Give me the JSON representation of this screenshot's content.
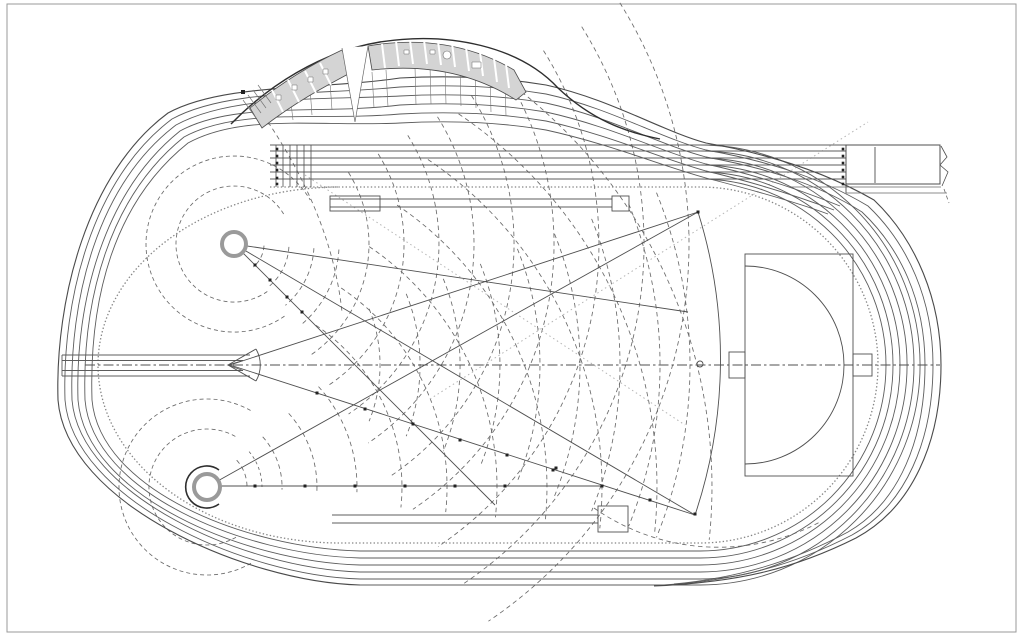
{
  "meta": {
    "description": "Architectural site plan drawing of an athletics stadium: six-lane 400m running track with sprint straight extension, curved grandstand building with changing rooms along the north curve, javelin runway and landing sector, two throwing circles with caged hammer/discus sectors, dashed distance arcs, long jump runways and a D-shaped event area inside the eastern curve"
  },
  "canvas": {
    "width": 1024,
    "height": 639,
    "background": "#ffffff"
  },
  "palette": {
    "line": "#4f4f4f",
    "track": "#5c5c5c",
    "dashline": "#6a6a6a",
    "faint": "#b5b5b5",
    "kerb": "#858585",
    "dark": "#2e2e2e",
    "building_fill": "#d4d4d4",
    "paper": "#ffffff"
  },
  "shapes": [
    {
      "name": "sheet-frame",
      "type": "rect",
      "x": 7,
      "y": 4,
      "w": 1009,
      "h": 628,
      "stroke": "#9a9a9a",
      "w2": 1
    },
    {
      "name": "javelin-distance-arc-fan",
      "type": "fan",
      "cx": 230,
      "cy": 365,
      "radii": [
        150,
        190,
        230,
        270,
        310,
        350,
        390,
        430,
        460
      ],
      "a0": -22,
      "a1": 22,
      "stroke": "#6a6a6a",
      "w2": 0.85,
      "dash": "4.5 3.5"
    },
    {
      "name": "upper-circle-near-arc-fan",
      "type": "fan",
      "cx": 234,
      "cy": 244,
      "radii": [
        30,
        55,
        80,
        105
      ],
      "a0": 3,
      "a1": 50,
      "stroke": "#6a6a6a",
      "w2": 0.85,
      "dash": "4.5 3.5"
    },
    {
      "name": "upper-circle-far-arc-fan",
      "type": "fan",
      "cx": 234,
      "cy": 244,
      "radii": [
        135,
        170,
        205,
        240,
        280,
        320,
        365,
        410,
        455
      ],
      "a0": -32,
      "a1": 56,
      "stroke": "#6a6a6a",
      "w2": 0.85,
      "dash": "4.5 3.5"
    },
    {
      "name": "upper-circle-safety-circles",
      "type": "fan",
      "cx": 234,
      "cy": 244,
      "radii": [
        58,
        88
      ],
      "a0": 55,
      "a1": 330,
      "stroke": "#6a6a6a",
      "w2": 0.85,
      "dash": "4 3"
    },
    {
      "name": "lower-circle-near-arc-fan",
      "type": "fan",
      "cx": 207,
      "cy": 487,
      "radii": [
        40,
        75,
        110,
        150
      ],
      "a0": -42,
      "a1": 2,
      "stroke": "#6a6a6a",
      "w2": 0.85,
      "dash": "4.5 3.5"
    },
    {
      "name": "lower-circle-far-arc-fan",
      "type": "fan",
      "cx": 207,
      "cy": 487,
      "radii": [
        195,
        240,
        290,
        340,
        395,
        450,
        505
      ],
      "a0": -56,
      "a1": 6,
      "stroke": "#6a6a6a",
      "w2": 0.85,
      "dash": "4.5 3.5"
    },
    {
      "name": "lower-circle-safety-circles",
      "type": "fan",
      "cx": 207,
      "cy": 487,
      "radii": [
        58,
        88
      ],
      "a0": 60,
      "a1": 300,
      "stroke": "#6a6a6a",
      "w2": 0.85,
      "dash": "4 3"
    },
    {
      "name": "lower-circle-vertex-arc",
      "type": "fan",
      "cx": 207,
      "cy": 487,
      "radii": [
        55
      ],
      "a0": -40,
      "a1": 0,
      "stroke": "#6a6a6a",
      "w2": 0.85,
      "dash": "3 3"
    },
    {
      "name": "construction-arc-northwest",
      "type": "path",
      "d": "M 268,122 Q 332,218 342,312",
      "stroke": "#6a6a6a",
      "w2": 0.85,
      "dash": "4.5 3.5"
    },
    {
      "name": "construction-arc-southeast",
      "type": "path",
      "d": "M 594,508 A 217,217 0 0 0 820,522",
      "stroke": "#6a6a6a",
      "w2": 0.85,
      "dash": "4.5 3.5"
    },
    {
      "name": "dotted-sightline-ne",
      "type": "line",
      "x1": 430,
      "y1": 399,
      "x2": 868,
      "y2": 122,
      "stroke": "#b5b5b5",
      "w2": 1,
      "dash": "1.5 3"
    },
    {
      "name": "dotted-sightline-se",
      "type": "line",
      "x1": 305,
      "y1": 175,
      "x2": 685,
      "y2": 425,
      "stroke": "#b5b5b5",
      "w2": 1,
      "dash": "1.5 3"
    },
    {
      "name": "infield-kerb-ticked",
      "type": "path",
      "d": "M 270,187 L 700,187 A 178,178 0 1 1 700,543 L 340,543 A 242,178 0 1 1 340,187",
      "stroke": "#858585",
      "w2": 1.3,
      "dash": "1.4 2.2"
    },
    {
      "name": "track-lane-1",
      "type": "path",
      "d": "M 270,179 L 846,179 M 700,179 A 186,186 0 1 1 700,551 L 360,551",
      "stroke": "#5c5c5c",
      "w2": 0.9
    },
    {
      "name": "track-lane-2",
      "type": "path",
      "d": "M 270,172 L 846,172 M 700,172 A 193,193 0 1 1 700,558 L 360,558",
      "stroke": "#5c5c5c",
      "w2": 0.9
    },
    {
      "name": "track-lane-3",
      "type": "path",
      "d": "M 270,165 L 846,165 M 700,165 A 200,200 0 1 1 700,565 L 360,565",
      "stroke": "#5c5c5c",
      "w2": 0.9
    },
    {
      "name": "track-lane-4",
      "type": "path",
      "d": "M 270,158 L 846,158 M 700,158 A 207,207 0 1 1 700,572 L 360,572",
      "stroke": "#5c5c5c",
      "w2": 0.9
    },
    {
      "name": "track-lane-5",
      "type": "path",
      "d": "M 270,151 L 846,151 M 700,151 A 214,214 0 1 1 700,579 L 360,579",
      "stroke": "#5c5c5c",
      "w2": 0.9
    },
    {
      "name": "track-lane-6",
      "type": "path",
      "d": "M 270,145 L 846,145 M 700,145 A 220,220 0 1 1 700,585 L 360,585",
      "stroke": "#5c5c5c",
      "w2": 0.9
    },
    {
      "name": "sweep-lane-1",
      "type": "path",
      "d": "M 360,551 C 245,548 100,490 92,400 C 89,300 113,203 188,143 C 243,113 320,127 400,123 C 455,120 505,123 546,130 C 610,144 662,166 706,178 C 745,188 790,200 828,214",
      "stroke": "#5c5c5c",
      "w2": 0.9
    },
    {
      "name": "sweep-lane-2",
      "type": "path",
      "d": "M 360,558 C 245,555 93,493 85,400 C 82,300 109,197 184,137 C 239,107 320,121 400,114 C 455,111 505,114 546,121 C 610,135 662,159 706,171 C 748,181 792,194 834,210",
      "stroke": "#5c5c5c",
      "w2": 0.9
    },
    {
      "name": "sweep-lane-3",
      "type": "path",
      "d": "M 360,565 C 245,562 86,496 78,400 C 75,300 105,191 180,131 C 235,101 320,115 400,105 C 455,102 505,105 546,112 C 610,126 662,152 706,164 C 752,174 796,188 840,206",
      "stroke": "#5c5c5c",
      "w2": 0.9
    },
    {
      "name": "sweep-lane-4",
      "type": "path",
      "d": "M 360,572 C 245,569 80,495 72,400 C 69,300 97,185 176,125 C 231,95 320,100 400,96 C 455,93 505,96 546,103 C 610,117 660,145 706,157 C 760,167 815,182 862,212 C 900,248 925,300 925,365 C 925,438 900,502 848,532 C 792,562 737,578 674,584",
      "stroke": "#5c5c5c",
      "w2": 0.9
    },
    {
      "name": "sweep-lane-5",
      "type": "path",
      "d": "M 360,579 C 245,576 73,499 65,400 C 62,300 92,179 172,119 C 227,89 320,95 400,87 C 455,84 505,87 546,94 C 610,108 660,138 706,150 C 762,160 818,176 868,206 C 908,244 933,300 933,365 C 933,440 906,505 852,535 C 794,565 739,580 664,585",
      "stroke": "#5c5c5c",
      "w2": 0.9
    },
    {
      "name": "sweep-lane-6-outer-boundary",
      "type": "path",
      "d": "M 360,585 C 245,582 66,503 58,400 C 55,300 87,173 168,113 C 223,83 320,90 400,78 C 455,75 505,78 546,85 C 610,99 662,131 706,143 C 764,153 822,170 874,200 C 916,240 941,300 941,365 C 941,442 912,508 856,538 C 796,568 741,582 654,586",
      "stroke": "#4a4a4a",
      "w2": 1.1
    },
    {
      "name": "sprint-start-lines",
      "type": "path",
      "d": "M 276,145 V 187 M 283,145 V 187 M 290,145 V 187 M 297,145 V 187 M 304,145 V 187 M 311,145 V 187",
      "stroke": "#4f4f4f",
      "w2": 0.8
    },
    {
      "name": "finish-lines",
      "type": "path",
      "d": "M 846,145 V 193 M 875,147 V 183",
      "stroke": "#4f4f4f",
      "w2": 0.9
    },
    {
      "name": "finish-runout-box",
      "type": "rect",
      "x": 846,
      "y": 145,
      "w": 94,
      "h": 39,
      "stroke": "#4f4f4f",
      "w2": 1
    },
    {
      "name": "finish-runout-apron",
      "type": "path",
      "d": "M 790,187 H 941 M 846,193 H 947",
      "stroke": "#6a6a6a",
      "w2": 0.8
    },
    {
      "name": "drawing-break-line",
      "type": "polyline",
      "pts": [
        [
          941,
          146
        ],
        [
          947,
          157
        ],
        [
          940,
          165
        ],
        [
          948,
          172
        ],
        [
          942,
          186
        ]
      ],
      "stroke": "#4f4f4f",
      "w2": 0.8
    },
    {
      "name": "drawing-break-dash",
      "type": "line",
      "x1": 944,
      "y1": 189,
      "x2": 949,
      "y2": 203,
      "stroke": "#6a6a6a",
      "w2": 0.8,
      "dash": "4 3"
    },
    {
      "name": "infield-centre-axis",
      "type": "line",
      "x1": 85,
      "y1": 365,
      "x2": 940,
      "y2": 365,
      "stroke": "#4f4f4f",
      "w2": 0.9,
      "dash": "10 3 2.5 3"
    },
    {
      "name": "javelin-runway",
      "type": "path",
      "d": "M 62,355 H 250 M 62,376 H 250 M 62,360.5 H 243 M 62,370.5 H 243 M 62,355 V 376 M 243,360.5 L 228,365 L 243,370.5",
      "stroke": "#5c5c5c",
      "w2": 0.9
    },
    {
      "name": "javelin-foul-arc",
      "type": "path",
      "d": "M 256,349 A 32,32 0 0 1 256,381 M 228,365 L 256,349 M 228,365 L 256,381",
      "stroke": "#4f4f4f",
      "w2": 0.9
    },
    {
      "name": "javelin-sector-edge-north",
      "type": "line",
      "x1": 230,
      "y1": 365,
      "x2": 698,
      "y2": 212,
      "stroke": "#4f4f4f",
      "w2": 0.9
    },
    {
      "name": "javelin-sector-edge-south",
      "type": "line",
      "x1": 230,
      "y1": 365,
      "x2": 695,
      "y2": 515,
      "stroke": "#4f4f4f",
      "w2": 0.9
    },
    {
      "name": "javelin-sector-arc",
      "type": "path",
      "d": "M 698,212 A 491,491 0 0 1 695,515",
      "stroke": "#4f4f4f",
      "w2": 0.9
    },
    {
      "name": "upper-sector-long-edge",
      "type": "line",
      "x1": 234,
      "y1": 244,
      "x2": 695,
      "y2": 515,
      "stroke": "#4f4f4f",
      "w2": 0.9
    },
    {
      "name": "lower-sector-long-edge",
      "type": "line",
      "x1": 207,
      "y1": 487,
      "x2": 698,
      "y2": 212,
      "stroke": "#4f4f4f",
      "w2": 0.9
    },
    {
      "name": "upper-sector-edge-a",
      "type": "line",
      "x1": 234,
      "y1": 244,
      "x2": 688,
      "y2": 312,
      "stroke": "#4f4f4f",
      "w2": 0.9
    },
    {
      "name": "upper-sector-edge-b",
      "type": "line",
      "x1": 234,
      "y1": 244,
      "x2": 495,
      "y2": 505,
      "stroke": "#4f4f4f",
      "w2": 0.9
    },
    {
      "name": "lower-sector-edge-horizontal",
      "type": "line",
      "x1": 220,
      "y1": 486,
      "x2": 602,
      "y2": 486,
      "stroke": "#4f4f4f",
      "w2": 0.9
    },
    {
      "name": "upper-throwing-circle",
      "type": "circle",
      "cx": 234,
      "cy": 244,
      "r": 12,
      "stroke": "#9a9a9a",
      "w2": 4,
      "fill": "#ffffff"
    },
    {
      "name": "lower-throwing-circle",
      "type": "circle",
      "cx": 207,
      "cy": 487,
      "r": 13,
      "stroke": "#9a9a9a",
      "w2": 4,
      "fill": "#ffffff"
    },
    {
      "name": "lower-circle-cage",
      "type": "path",
      "d": "M 219,504 A 21,21 0 1 1 219,470",
      "stroke": "#2e2e2e",
      "w2": 1.6
    },
    {
      "name": "north-jump-runway",
      "type": "path",
      "d": "M 330,199 H 612 M 330,207 H 612",
      "stroke": "#5c5c5c",
      "w2": 0.9
    },
    {
      "name": "north-jump-pit",
      "type": "rect",
      "x": 330,
      "y": 196,
      "w": 50,
      "h": 15,
      "stroke": "#4f4f4f",
      "w2": 0.9
    },
    {
      "name": "north-jump-board",
      "type": "rect",
      "x": 612,
      "y": 196,
      "w": 17,
      "h": 15,
      "stroke": "#4f4f4f",
      "w2": 0.9
    },
    {
      "name": "south-jump-runway",
      "type": "path",
      "d": "M 332,515 H 598 M 332,523 H 598",
      "stroke": "#5c5c5c",
      "w2": 0.9
    },
    {
      "name": "south-jump-pit",
      "type": "rect",
      "x": 598,
      "y": 506,
      "w": 30,
      "h": 26,
      "stroke": "#4f4f4f",
      "w2": 0.9
    },
    {
      "name": "east-event-area",
      "type": "rect",
      "x": 745,
      "y": 254,
      "w": 108,
      "h": 222,
      "stroke": "#4f4f4f",
      "w2": 0.9
    },
    {
      "name": "east-event-d-arc",
      "type": "path",
      "d": "M 745,266 A 99,99 0 0 1 745,464",
      "stroke": "#4f4f4f",
      "w2": 0.9
    },
    {
      "name": "east-event-box-west",
      "type": "rect",
      "x": 729,
      "y": 352,
      "w": 16,
      "h": 26,
      "stroke": "#4f4f4f",
      "w2": 0.9
    },
    {
      "name": "east-event-box-east",
      "type": "rect",
      "x": 853,
      "y": 354,
      "w": 19,
      "h": 22,
      "stroke": "#4f4f4f",
      "w2": 0.9
    },
    {
      "name": "curve-centre-marker",
      "type": "circle",
      "cx": 700,
      "cy": 364,
      "r": 3,
      "stroke": "#4f4f4f",
      "w2": 0.9
    },
    {
      "name": "terrace-step-lines",
      "type": "path",
      "d": "M 290,95 L 293,120 M 310,88 L 312,115 M 330,82 L 332,110 M 372,72 L 374,108 M 386,70 L 388,107 M 415,67 L 416,105 M 430,66 L 431,104 M 445,66 L 446,104 M 460,67 L 461,106 M 475,70 L 476,108 M 490,74 L 491,112 M 505,80 L 506,116",
      "stroke": "#767676",
      "w2": 0.6
    },
    {
      "name": "grandstand-canopy-edge",
      "type": "path",
      "d": "M 231,124 C 268,86 320,52 380,42 C 450,31 520,47 558,88 C 592,120 625,132 660,139",
      "stroke": "#2e2e2e",
      "w2": 1.4
    },
    {
      "name": "building-west-wing",
      "type": "path",
      "d": "M 250,108 C 282,82 312,64 342,50 L 352,72 C 322,88 294,103 262,128 Z",
      "stroke": "#4a4a4a",
      "w2": 0.8,
      "fill": "#d4d4d4"
    },
    {
      "name": "building-east-wing",
      "type": "path",
      "d": "M 368,46 C 420,37 470,44 514,70 L 526,92 L 516,100 C 472,72 424,64 372,70 Z",
      "stroke": "#4a4a4a",
      "w2": 0.8,
      "fill": "#d4d4d4"
    },
    {
      "name": "west-wing-partitions",
      "type": "path",
      "d": "M 272,90 L 283,112 M 288,80 L 299,102 M 305,71 L 316,93 M 320,63 L 331,85",
      "stroke": "#ffffff",
      "w2": 2
    },
    {
      "name": "east-wing-partitions",
      "type": "path",
      "d": "M 382,44 L 385,68 M 396,41 L 399,66 M 410,40 L 413,64 M 424,40 L 427,64 M 438,41 L 441,65 M 452,43 L 455,67 M 466,47 L 469,71 M 480,52 L 483,76 M 494,58 L 497,82 M 506,64 L 509,88",
      "stroke": "#ffffff",
      "w2": 2
    },
    {
      "name": "west-wing-fixtures",
      "type": "path",
      "d": "M 276,95 h 5 v 5 h -5 Z M 292,85 h 5 v 5 h -5 Z M 308,77 h 5 v 5 h -5 Z M 323,69 h 5 v 5 h -5 Z",
      "stroke": "#6a6a6a",
      "w2": 0.5,
      "fill": "#ffffff"
    },
    {
      "name": "east-wing-fixtures",
      "type": "path",
      "d": "M 404,50 h 5 v 4 h -5 Z M 430,50 h 5 v 4 h -5 Z M 472,62 h 9 v 6 h -9 Z",
      "stroke": "#6a6a6a",
      "w2": 0.5,
      "fill": "#ffffff"
    },
    {
      "name": "east-wing-round-table",
      "type": "circle",
      "cx": 447,
      "cy": 55,
      "r": 4,
      "stroke": "#6a6a6a",
      "w2": 0.6,
      "fill": "#ffffff"
    },
    {
      "name": "building-entrance-wedge",
      "type": "polyline",
      "pts": [
        [
          342,
          48
        ],
        [
          355,
          122
        ],
        [
          368,
          46
        ]
      ],
      "stroke": "#666666",
      "w2": 0.7,
      "fill": "#ffffff"
    },
    {
      "name": "west-stair-hatch",
      "type": "path",
      "d": "M 243,100 L 256,118 M 248,95 L 261,113 M 253,90 L 266,108 M 258,85 L 271,103",
      "stroke": "#767676",
      "w2": 0.7
    },
    {
      "name": "upper-edge-markers",
      "type": "marks",
      "s": 3,
      "pts": [
        [
          255,
          265
        ],
        [
          270,
          280
        ],
        [
          287,
          297
        ],
        [
          302,
          312
        ]
      ],
      "fill": "#222222"
    },
    {
      "name": "javelin-edge-markers",
      "type": "marks",
      "s": 3,
      "pts": [
        [
          317,
          393
        ],
        [
          365,
          409
        ],
        [
          413,
          424
        ],
        [
          460,
          440
        ],
        [
          507,
          455
        ],
        [
          553,
          470
        ],
        [
          556,
          468
        ],
        [
          602,
          486
        ],
        [
          650,
          500
        ],
        [
          695,
          514
        ],
        [
          698,
          212
        ]
      ],
      "fill": "#222222"
    },
    {
      "name": "lower-edge-markers",
      "type": "marks",
      "s": 3,
      "pts": [
        [
          255,
          486
        ],
        [
          305,
          486
        ],
        [
          355,
          486
        ],
        [
          405,
          486
        ],
        [
          455,
          486
        ],
        [
          505,
          486
        ]
      ],
      "fill": "#222222"
    },
    {
      "name": "sprint-start-markers",
      "type": "marks",
      "s": 2.6,
      "pts": [
        [
          277,
          149
        ],
        [
          277,
          156
        ],
        [
          277,
          163
        ],
        [
          277,
          170
        ],
        [
          277,
          178
        ],
        [
          277,
          184
        ]
      ],
      "fill": "#222222"
    },
    {
      "name": "finish-markers",
      "type": "marks",
      "s": 2.6,
      "pts": [
        [
          843,
          149
        ],
        [
          843,
          156
        ],
        [
          843,
          163
        ],
        [
          843,
          170
        ],
        [
          843,
          177
        ],
        [
          843,
          184
        ]
      ],
      "fill": "#222222"
    },
    {
      "name": "canopy-node-marker",
      "type": "marks",
      "s": 4,
      "pts": [
        [
          243,
          92
        ]
      ],
      "fill": "#222222"
    }
  ]
}
